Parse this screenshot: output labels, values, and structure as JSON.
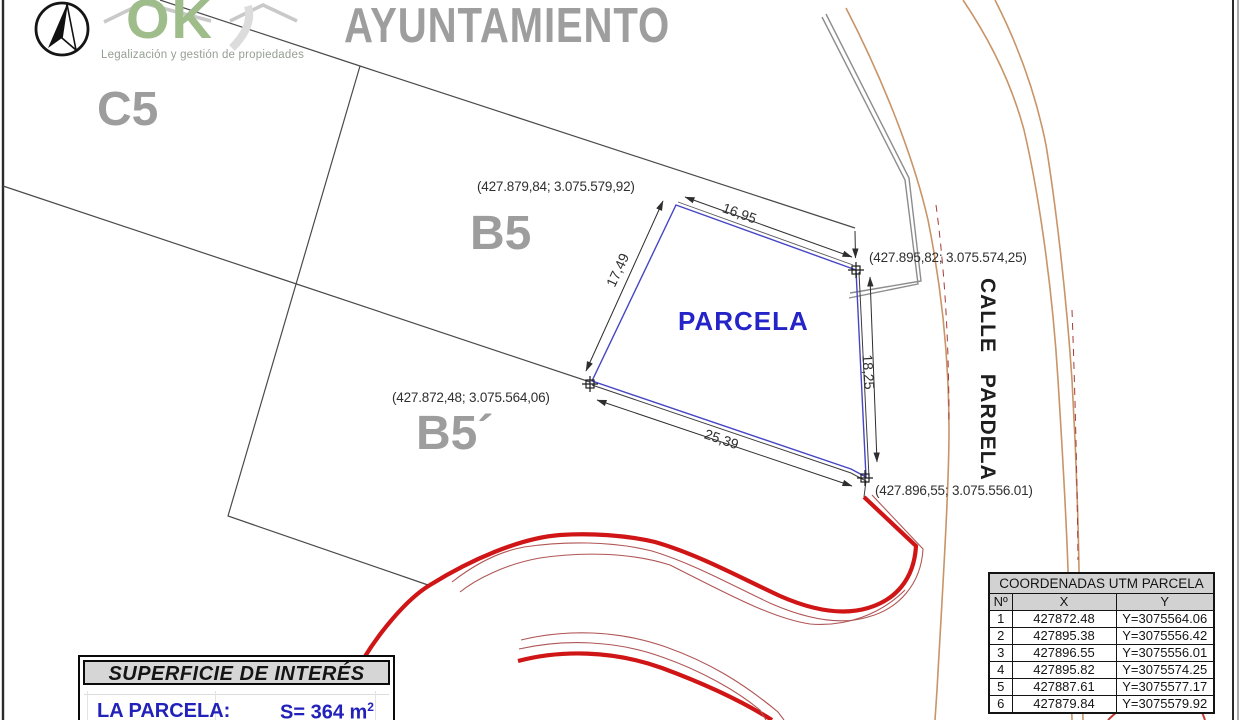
{
  "logo": {
    "brand": "OK",
    "tagline": "Legalización y gestión de propiedades"
  },
  "header": {
    "title": "AYUNTAMIENTO"
  },
  "zones": {
    "c5": "C5",
    "b5": "B5",
    "b5_prime": "B5´"
  },
  "parcel": {
    "label": "PARCELA",
    "street_label": "CALLE PARDELA",
    "corners": {
      "top_left": "(427.879,84; 3.075.579,92)",
      "top_right": "(427.895,82; 3.075.574,25)",
      "bottom_left": "(427.872,48; 3.075.564,06)",
      "bottom_right": "(427.896,55; 3.075.556.01)"
    },
    "dimensions": {
      "top": "16,95",
      "left": "17,49",
      "right": "18,25",
      "bottom": "25,39"
    }
  },
  "utm_table": {
    "title": "COORDENADAS UTM PARCELA",
    "columns": [
      "Nº",
      "X",
      "Y"
    ],
    "rows": [
      [
        "1",
        "427872.48",
        "Y=3075564.06"
      ],
      [
        "2",
        "427895.38",
        "Y=3075556.42"
      ],
      [
        "3",
        "427896.55",
        "Y=3075556.01"
      ],
      [
        "4",
        "427895.82",
        "Y=3075574.25"
      ],
      [
        "5",
        "427887.61",
        "Y=3075577.17"
      ],
      [
        "6",
        "427879.84",
        "Y=3075579.92"
      ]
    ]
  },
  "surface_box": {
    "title": "SUPERFICIE DE INTERÉS",
    "item_label": "LA PARCELA:",
    "value": "S= 364 m",
    "value_sup": "2"
  },
  "colors": {
    "parcel_blue": "#4646c4",
    "label_blue": "#2424c8",
    "zone_gray": "#9d9d9d",
    "road_red": "#cf1515",
    "street_tan": "#c89468",
    "logo_green": "#9fbd8b"
  }
}
